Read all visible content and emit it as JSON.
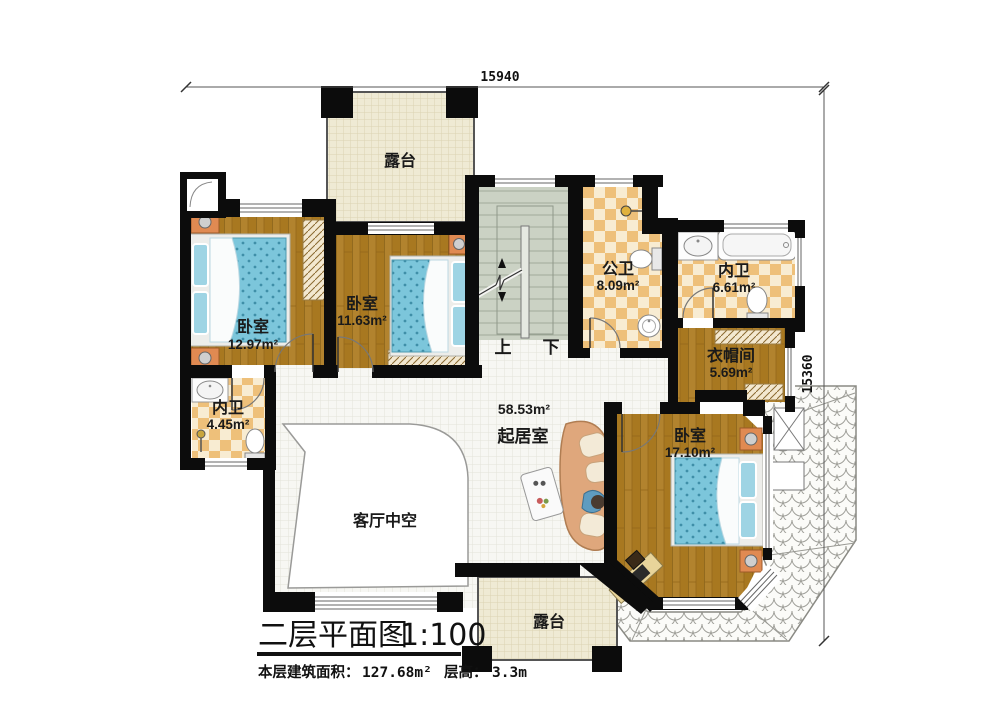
{
  "dimensions": {
    "top": "15940",
    "right": "15360"
  },
  "rooms": {
    "terrace_top": {
      "name": "露台"
    },
    "bedroom_left": {
      "name": "卧室",
      "area": "12.97m²"
    },
    "bedroom_mid": {
      "name": "卧室",
      "area": "11.63m²"
    },
    "bath_public": {
      "name": "公卫",
      "area": "8.09m²"
    },
    "bath_ensuite_right": {
      "name": "内卫",
      "area": "6.61m²"
    },
    "closet": {
      "name": "衣帽间",
      "area": "5.69m²"
    },
    "bath_ensuite_left": {
      "name": "内卫",
      "area": "4.45m²"
    },
    "living": {
      "name": "起居室",
      "area": "58.53m²"
    },
    "bedroom_right": {
      "name": "卧室",
      "area": "17.10m²"
    },
    "void_over_hall": {
      "name": "客厅中空"
    },
    "terrace_bottom": {
      "name": "露台"
    }
  },
  "stairs": {
    "up_label": "上",
    "down_label": "下"
  },
  "title_block": {
    "title": "二层平面图",
    "scale": "1:100",
    "floor_area_label": "本层建筑面积：",
    "floor_area_value": "127.68m²",
    "floor_height_label": "层高：",
    "floor_height_value": "3.3m"
  },
  "colors": {
    "wall": "#0c0c0c",
    "wood_floor": "#a87820",
    "checker_dark": "#eec07a",
    "checker_light": "#f8ecd2",
    "terrace_floor": "#efead4",
    "tile_floor": "#f7f7f3",
    "stairs_floor": "#cbd2c4",
    "mattress_blue": "#7cc6db",
    "furniture_orange": "#e08a52"
  }
}
